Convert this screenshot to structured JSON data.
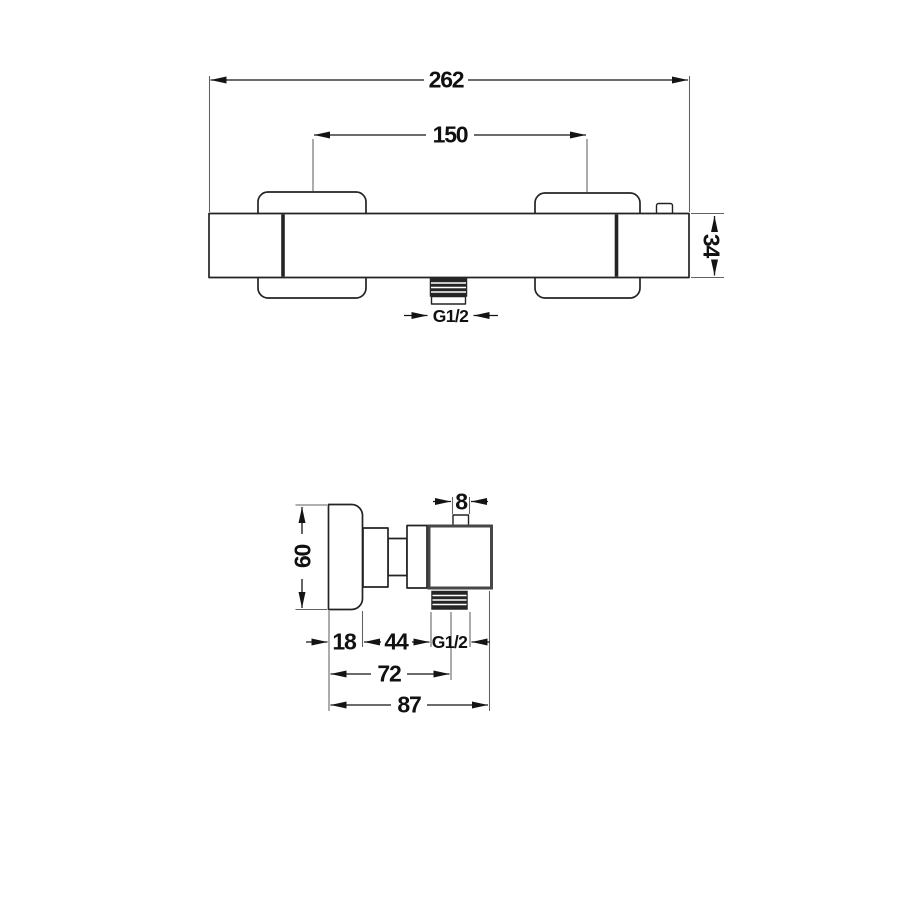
{
  "drawing": {
    "top_view": {
      "overall_width": "262",
      "connection_spacing": "150",
      "body_height": "34",
      "thread_label": "G1/2"
    },
    "side_view": {
      "handle_height": "60",
      "tab_width": "8",
      "handle_depth": "18",
      "neck_length": "44",
      "thread_label": "G1/2",
      "depth_to_thread_center": "72",
      "total_depth": "87"
    },
    "colors": {
      "background": "#ffffff",
      "part_outline": "#232323",
      "valve_body_outline": "#474747",
      "dimension_line": "#141414",
      "extension_line": "#616161",
      "thread_fill": "#262626"
    }
  }
}
